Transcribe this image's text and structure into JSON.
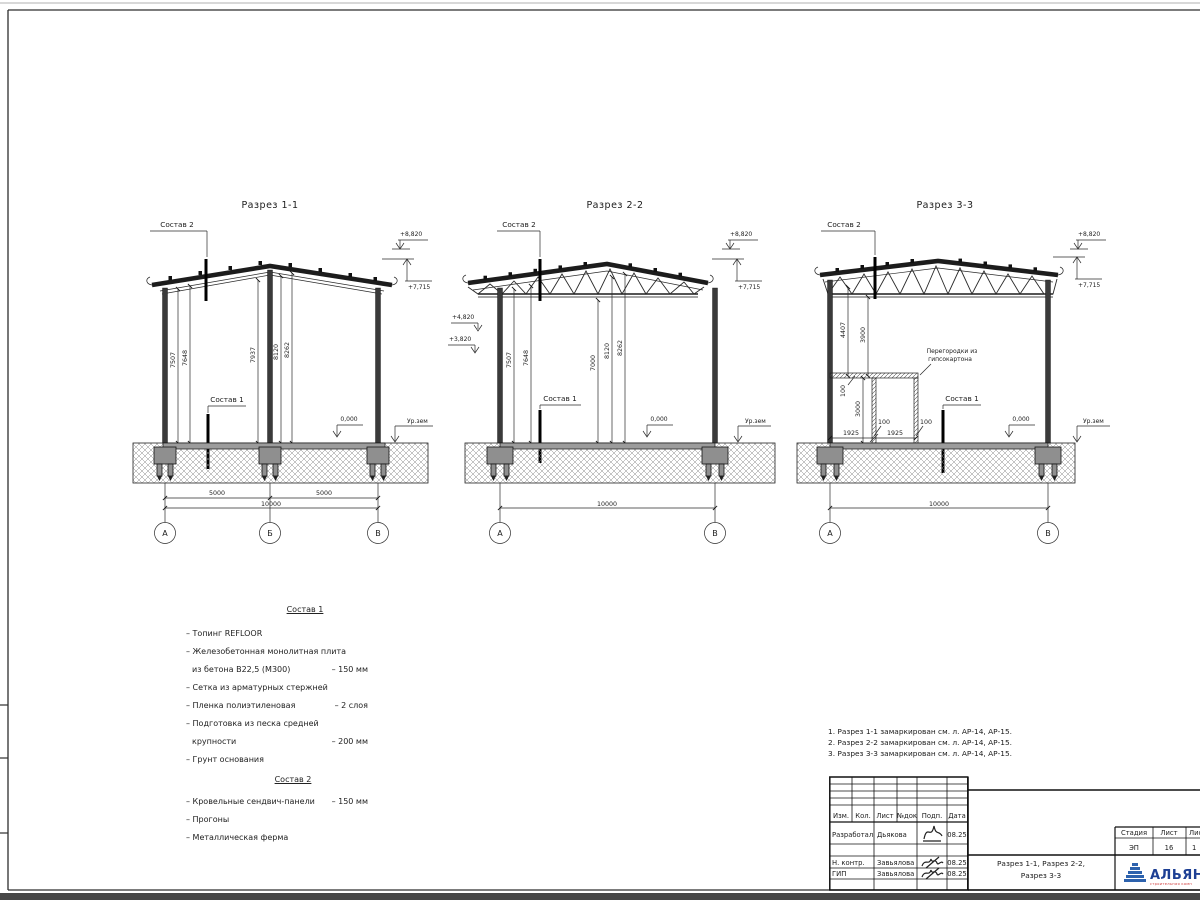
{
  "sections": [
    {
      "title": "Разрез 1-1",
      "label_sostav1": "Состав 1",
      "label_sostav2": "Состав 2",
      "elev_ridge": "+8,820",
      "elev_eave": "+7,715",
      "elev_zero": "0,000",
      "label_ground": "Ур.зем",
      "vdims": [
        "7507",
        "7648",
        "7937",
        "8120",
        "8262"
      ],
      "hdim_1": "5000",
      "hdim_2": "5000",
      "hdim_total": "10000",
      "axis_a": "А",
      "axis_b": "Б",
      "axis_c": "В"
    },
    {
      "title": "Разрез 2-2",
      "label_sostav1": "Состав 1",
      "label_sostav2": "Состав 2",
      "elev_ridge": "+8,820",
      "elev_eave": "+7,715",
      "elev_left_1": "+4,820",
      "elev_left_2": "+3,820",
      "elev_zero": "0,000",
      "label_ground": "Ур.зем",
      "vdims": [
        "7507",
        "7648",
        "7000",
        "8120",
        "8262"
      ],
      "hdim_total": "10000",
      "axis_a": "А",
      "axis_c": "В"
    },
    {
      "title": "Разрез 3-3",
      "label_sostav1": "Состав 1",
      "label_sostav2": "Состав 2",
      "elev_ridge": "+8,820",
      "elev_eave": "+7,715",
      "elev_zero": "0,000",
      "label_ground": "Ур.зем",
      "vdims": [
        "4407",
        "3900"
      ],
      "partition_label_1": "Перегородки из",
      "partition_label_2": "гипсокартона",
      "pdim_100_top": "100",
      "pdim_3000": "3000",
      "pdim_1925_a": "1925",
      "pdim_100_a": "100",
      "pdim_1925_b": "1925",
      "pdim_100_b": "100",
      "hdim_total": "10000",
      "axis_a": "А",
      "axis_c": "В"
    }
  ],
  "legend": {
    "sostav1_title": "Состав 1",
    "sostav1_items": [
      {
        "text": "– Топинг REFLOOR",
        "value": ""
      },
      {
        "text": "– Железобетонная  монолитная плита",
        "value": ""
      },
      {
        "text": "из бетона В22,5 (М300)",
        "value": "– 150 мм"
      },
      {
        "text": "– Сетка из арматурных стержней",
        "value": ""
      },
      {
        "text": "– Пленка полиэтиленовая",
        "value": "– 2 слоя"
      },
      {
        "text": "– Подготовка из песка средней",
        "value": ""
      },
      {
        "text": "крупности",
        "value": "– 200 мм"
      },
      {
        "text": "– Грунт основания",
        "value": ""
      }
    ],
    "sostav2_title": "Состав 2",
    "sostav2_items": [
      {
        "text": "– Кровельные сендвич-панели",
        "value": "– 150 мм"
      },
      {
        "text": "– Прогоны",
        "value": ""
      },
      {
        "text": "– Металлическая ферма",
        "value": ""
      }
    ]
  },
  "notes": [
    "1. Разрез 1-1 замаркирован см. л. АР-14, АР-15.",
    "2. Разрез 2-2 замаркирован см. л. АР-14, АР-15.",
    "3. Разрез 3-3 замаркирован см. л. АР-14, АР-15."
  ],
  "title_block": {
    "headers": [
      "Изм.",
      "Кол.",
      "Лист",
      "№док",
      "Подп.",
      "Дата"
    ],
    "rows": [
      {
        "role": "Разработал",
        "name": "Дьякова",
        "date": "08.25"
      },
      {
        "role": "Н. контр.",
        "name": "Завьялова",
        "date": "08.25"
      },
      {
        "role": "ГИП",
        "name": "Завьялова",
        "date": "08.25"
      }
    ],
    "stage_label": "Стадия",
    "sheet_label": "Лист",
    "sheets_label": "Лис",
    "stage": "ЭП",
    "sheet_no": "16",
    "sheets_total": "1",
    "doc_title_line1": "Разрез 1-1, Разрез 2-2,",
    "doc_title_line2": "Разрез 3-3",
    "logo_text": "АЛЬЯН",
    "logo_sub": "строительная комп"
  },
  "colors": {
    "logo_blue": "#2d62ad",
    "logo_text_blue": "#1d3f94",
    "logo_red": "#d03a3a",
    "line": "#1c1c1c"
  }
}
